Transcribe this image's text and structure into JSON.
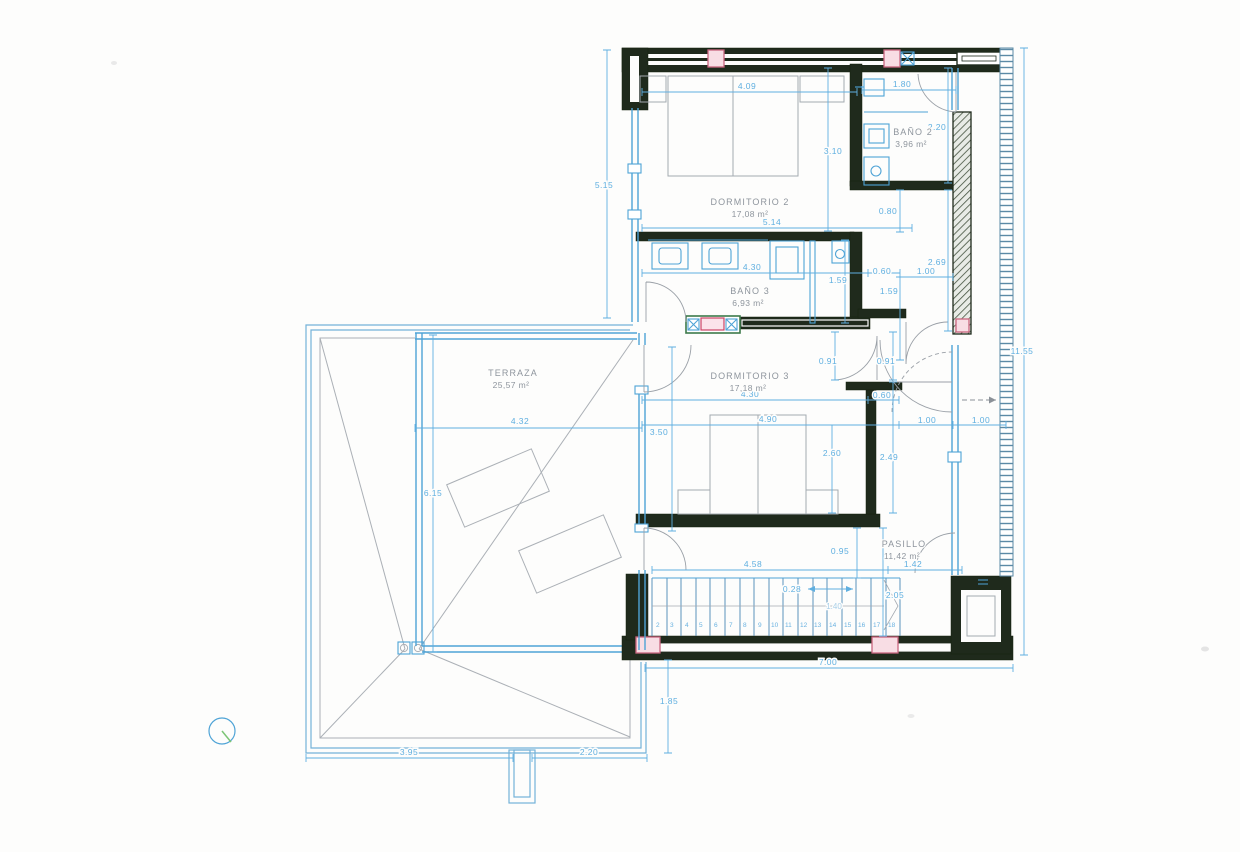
{
  "rooms": {
    "dormitorio2": {
      "name": "DORMITORIO 2",
      "area": "17,08 m²"
    },
    "bano2": {
      "name": "BAÑO 2",
      "area": "3,96 m²"
    },
    "bano3": {
      "name": "BAÑO 3",
      "area": "6,93 m²"
    },
    "dormitorio3": {
      "name": "DORMITORIO 3",
      "area": "17,18 m²"
    },
    "pasillo": {
      "name": "PASILLO",
      "area": "11,42 m²"
    },
    "terraza": {
      "name": "TERRAZA",
      "area": "25,57 m²"
    }
  },
  "dims": {
    "dorm2_bed_width": "4.09",
    "bano2_width": "1.80",
    "bano2_depth": "2.20",
    "dorm2_depth": "3.10",
    "shaft_depth": "0.80",
    "dorm2_width": "5.14",
    "east_upper": "2.69",
    "corr_up_a": "0.60",
    "corr_up_b": "1.00",
    "bano3_width": "4.30",
    "bano3_shower": "1.59",
    "corr_mid": "1.59",
    "door_a": "0.91",
    "door_b": "0.91",
    "dorm3_width": "4.30",
    "closet": "0.60",
    "dorm3_bed_width": "4.90",
    "terraza_east": "3.50",
    "dorm3_depth": "2.60",
    "corr_low": "2.49",
    "exit_a": "1.00",
    "exit_b": "1.00",
    "hall_depth": "0.95",
    "stairs_run": "4.58",
    "hall_end": "1.42",
    "tread": "0.28",
    "stair_mid": "1.40",
    "stair_width": "2.05",
    "total_bottom": "7.00",
    "below_stairs": "1.85",
    "left_total": "5.15",
    "right_total": "11.55",
    "terraza_width": "4.32",
    "terraza_depth": "6.15",
    "roof_left": "3.95",
    "roof_right": "2.20"
  },
  "stairs": {
    "numbers": [
      "2",
      "3",
      "4",
      "5",
      "6",
      "7",
      "8",
      "9",
      "10",
      "11",
      "12",
      "13",
      "14",
      "15",
      "16",
      "17",
      "18"
    ]
  }
}
